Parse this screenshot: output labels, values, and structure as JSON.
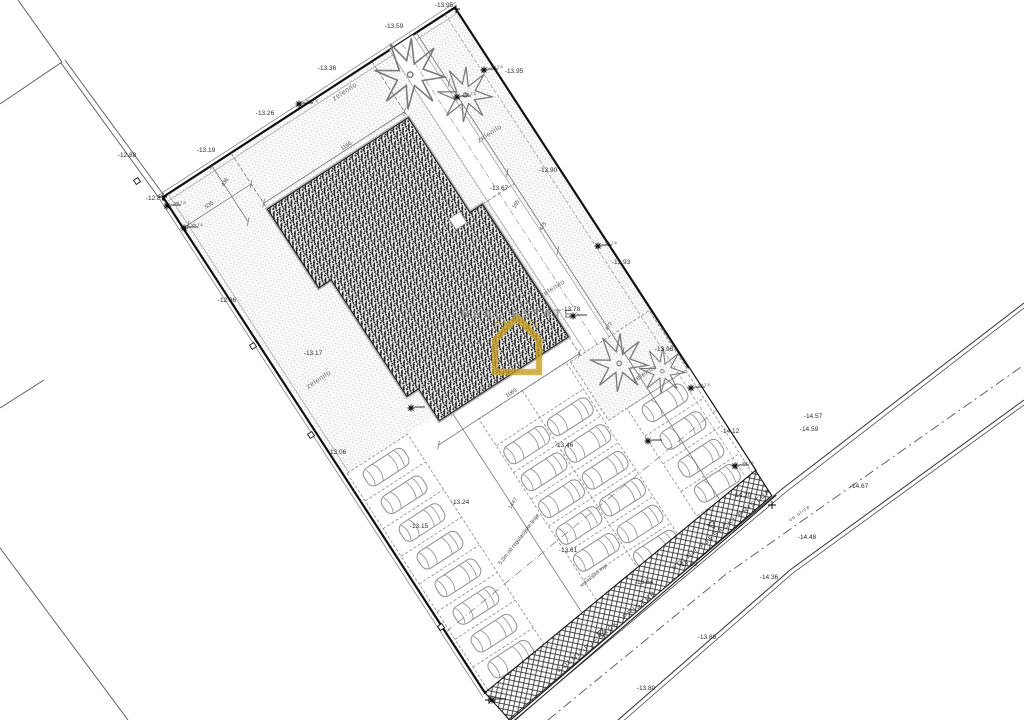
{
  "watermark": {
    "line1": "REAL ESTATE",
    "line2": "CROATIA"
  },
  "colors": {
    "gold": "#c9a227",
    "line": "#1a1a1a",
    "hatch_gray": "#c4c4c4"
  },
  "plan": {
    "elevation_labels": [
      {
        "text": "-13.95",
        "x": 444,
        "y": 6
      },
      {
        "text": "-13.59",
        "x": 394,
        "y": 27
      },
      {
        "text": "-13.36",
        "x": 327,
        "y": 69
      },
      {
        "text": "-13.26",
        "x": 265,
        "y": 114
      },
      {
        "text": "-13.19",
        "x": 206,
        "y": 151
      },
      {
        "text": "-12.88",
        "x": 127,
        "y": 156
      },
      {
        "text": "-12.87",
        "x": 155,
        "y": 199
      },
      {
        "text": "-12.86",
        "x": 227,
        "y": 301
      },
      {
        "text": "-13.17",
        "x": 313,
        "y": 354
      },
      {
        "text": "-13.06",
        "x": 337,
        "y": 453
      },
      {
        "text": "-13.95",
        "x": 514,
        "y": 72
      },
      {
        "text": "-13.90",
        "x": 548,
        "y": 171
      },
      {
        "text": "-13.67",
        "x": 499,
        "y": 189
      },
      {
        "text": "-13.93",
        "x": 621,
        "y": 263
      },
      {
        "text": "-13.78",
        "x": 571,
        "y": 310
      },
      {
        "text": "-13.96",
        "x": 664,
        "y": 350
      },
      {
        "text": "-14.12",
        "x": 730,
        "y": 432
      },
      {
        "text": "-14.57",
        "x": 813,
        "y": 417
      },
      {
        "text": "-14.59",
        "x": 809,
        "y": 430
      },
      {
        "text": "-14.67",
        "x": 859,
        "y": 487
      },
      {
        "text": "-14.48",
        "x": 807,
        "y": 538
      },
      {
        "text": "-14.36",
        "x": 769,
        "y": 578
      },
      {
        "text": "-14.20",
        "x": 742,
        "y": 496
      },
      {
        "text": "-13.89",
        "x": 688,
        "y": 565
      },
      {
        "text": "-13.64",
        "x": 644,
        "y": 583
      },
      {
        "text": "-13.86",
        "x": 707,
        "y": 638
      },
      {
        "text": "-13.80",
        "x": 646,
        "y": 689
      },
      {
        "text": "-13.61",
        "x": 568,
        "y": 551
      },
      {
        "text": "-13.46",
        "x": 564,
        "y": 446
      },
      {
        "text": "-13.24",
        "x": 460,
        "y": 503
      },
      {
        "text": "-13.15",
        "x": 419,
        "y": 527
      }
    ],
    "area_labels": [
      {
        "text": "zelenilo",
        "x": 345,
        "y": 92,
        "r": -33
      },
      {
        "text": "zelenilo",
        "x": 490,
        "y": 134,
        "r": -33
      },
      {
        "text": "zelenilo",
        "x": 553,
        "y": 289,
        "r": -33
      },
      {
        "text": "zelenilo",
        "x": 319,
        "y": 380,
        "r": -33
      },
      {
        "text": "zelenilo",
        "x": 645,
        "y": 374,
        "r": -33
      }
    ],
    "dimension_labels": [
      {
        "text": "1155",
        "x": 347,
        "y": 147,
        "r": -33
      },
      {
        "text": "535",
        "x": 210,
        "y": 206,
        "r": -33
      },
      {
        "text": "436",
        "x": 226,
        "y": 183,
        "r": -57
      },
      {
        "text": "165",
        "x": 517,
        "y": 205,
        "r": -57
      },
      {
        "text": "475",
        "x": 544,
        "y": 227,
        "r": -57
      },
      {
        "text": "472",
        "x": 610,
        "y": 327,
        "r": -57
      },
      {
        "text": "1065",
        "x": 512,
        "y": 394,
        "r": -33
      },
      {
        "text": "1447",
        "x": 514,
        "y": 504,
        "r": -57
      }
    ],
    "road_labels": [
      {
        "text": "KOLNI/ PJEŠAČKI PRISTUP",
        "x": 607,
        "y": 632,
        "r": -39,
        "fs": 7,
        "ls": 1.5
      },
      {
        "text": "KOLNI/ PJEŠAČKI PRISTUP",
        "x": 722,
        "y": 530,
        "r": -39,
        "fs": 7,
        "ls": 1.5
      },
      {
        "text": "os ulice",
        "x": 800,
        "y": 514,
        "r": -35,
        "fs": 5,
        "ls": 1
      },
      {
        "text": "5,0m od regulacijske linije",
        "x": 520,
        "y": 540,
        "r": -52,
        "fs": 5.5,
        "ls": 0
      },
      {
        "text": "regulacijska linija",
        "x": 594,
        "y": 576,
        "r": -39,
        "fs": 4.5,
        "ls": 0
      }
    ],
    "marker_labels": [
      {
        "text": "viš 7,5",
        "x": 312,
        "y": 101
      },
      {
        "text": "viš 7,5",
        "x": 470,
        "y": 94
      },
      {
        "text": "viš 7,5",
        "x": 497,
        "y": 67
      },
      {
        "text": "viš 7,5",
        "x": 611,
        "y": 243
      },
      {
        "text": "viš 7,5",
        "x": 704,
        "y": 385
      },
      {
        "text": "viš 7,5",
        "x": 180,
        "y": 203
      },
      {
        "text": "viš 7,5",
        "x": 197,
        "y": 225
      },
      {
        "text": "viš 7,5",
        "x": 748,
        "y": 463
      }
    ]
  }
}
